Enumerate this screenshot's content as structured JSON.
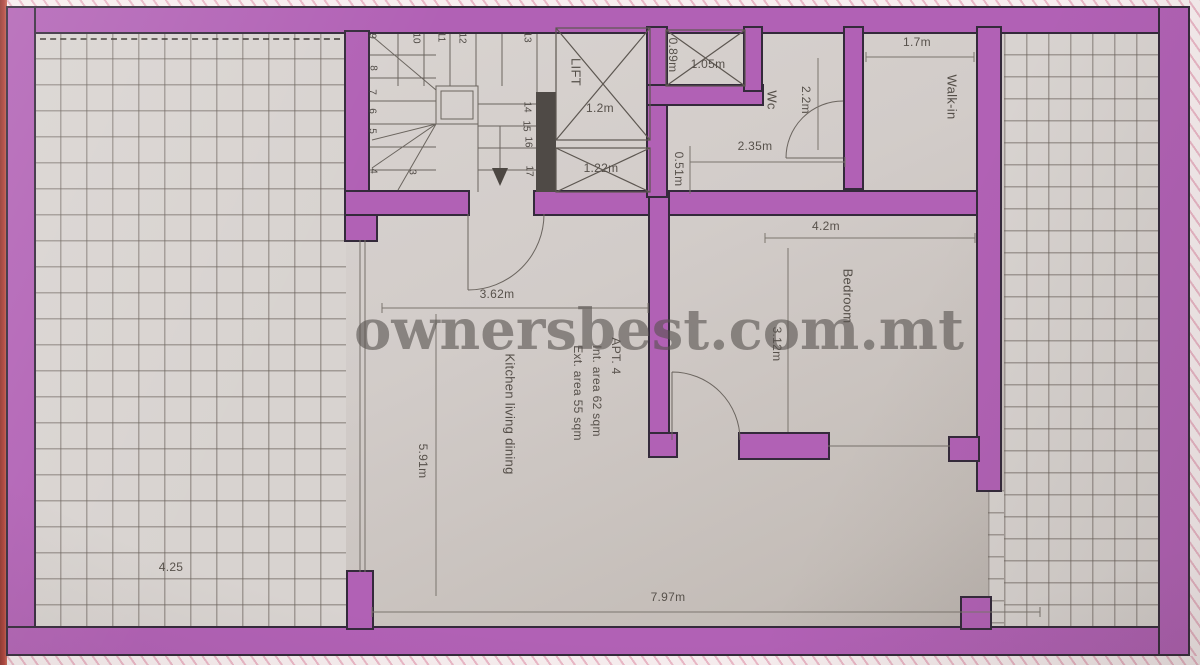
{
  "watermark": "ownersbest.com.mt",
  "apartment": {
    "title": "APT. 4",
    "int_area": "Int. area 62 sqm",
    "ext_area": "Ext. area 55 sqm"
  },
  "rooms": {
    "lift": "LIFT",
    "wc": "Wc",
    "walkin": "Walk-in",
    "bedroom": "Bedroom",
    "kitchen": "Kitchen living dining"
  },
  "dims": {
    "lift_width": "1.2m",
    "shaft_lower": "1.22m",
    "shaft_top_width": "1.05m",
    "shaft_top_height": "0.89m",
    "wc_depth": "2.2m",
    "hall_width": "2.35m",
    "hall_gap": "0.51m",
    "walkin_width": "1.7m",
    "bedroom_width": "4.2m",
    "bedroom_depth": "3.12m",
    "kitchen_width": "3.62m",
    "kitchen_depth": "5.91m",
    "living_width": "7.97m",
    "terrace_left": "4.25"
  },
  "stairs": {
    "numbers": [
      "9",
      "10",
      "11",
      "12",
      "13",
      "8",
      "7",
      "6",
      "5",
      "4",
      "3",
      "14",
      "15",
      "16",
      "17"
    ]
  },
  "colors": {
    "wall": "#b161b5",
    "wall_outline": "#342a3b",
    "dark_wall": "#4f4a46",
    "hatch_pink": "#e9b7c6",
    "edge_red": "#b04038"
  }
}
